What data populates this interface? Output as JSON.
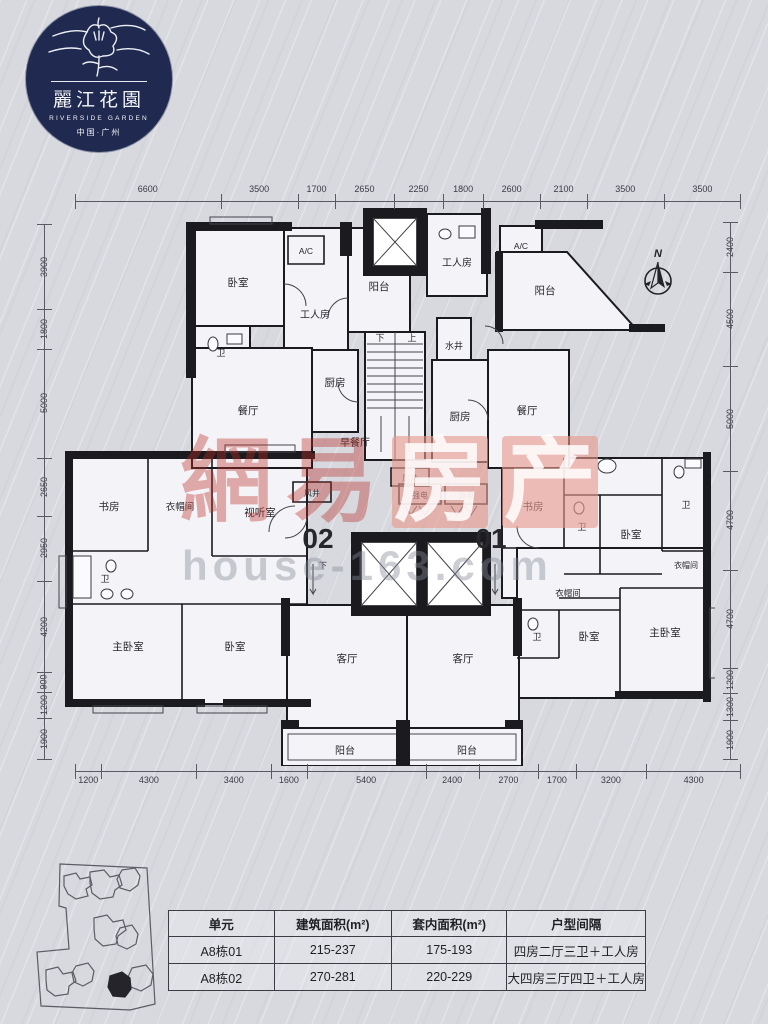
{
  "logo": {
    "name_cn": "麗江花園",
    "name_en": "RIVERSIDE GARDEN",
    "location": "中国·广州",
    "navy": "#202a50"
  },
  "compass": {
    "label": "N"
  },
  "dimensions": {
    "top": [
      6600,
      3500,
      1700,
      2650,
      2250,
      1800,
      2600,
      2100,
      3500,
      3500
    ],
    "bottom": [
      1200,
      4300,
      3400,
      1600,
      5400,
      2400,
      2700,
      1700,
      3200,
      4300
    ],
    "left": [
      3900,
      1800,
      5000,
      2650,
      2950,
      4200,
      900,
      1200,
      1900
    ],
    "right": [
      2400,
      4500,
      5000,
      4700,
      4700,
      1200,
      1300,
      1900
    ]
  },
  "plan": {
    "unit_left": "02",
    "unit_right": "01",
    "labels": {
      "bedroom": "卧室",
      "master_bedroom": "主卧室",
      "living_room": "客厅",
      "dining_room": "餐厅",
      "kitchen": "厨房",
      "balcony": "阳台",
      "worker_room": "工人房",
      "bathroom": "卫",
      "study": "书房",
      "cloakroom": "衣帽间",
      "av_room": "视听室",
      "breakfast_room": "早餐厅",
      "water_shaft": "水井",
      "air_shaft": "风井",
      "strong_electric": "强电",
      "weak_electric": "弱电",
      "up": "上",
      "down": "下",
      "ac": "A/C"
    },
    "accent_red": "#c4261d",
    "wall_color": "#1b1b1f"
  },
  "watermark": {
    "char1": "網",
    "char2": "易",
    "char3": "房",
    "char4": "产",
    "url": "house-163.com",
    "red": "#ba2c26",
    "pink": "#e9988c"
  },
  "table": {
    "headers": [
      "单元",
      "建筑面积(m²)",
      "套内面积(m²)",
      "户型间隔"
    ],
    "rows": [
      [
        "A8栋01",
        "215-237",
        "175-193",
        "四房二厅三卫＋工人房"
      ],
      [
        "A8栋02",
        "270-281",
        "220-229",
        "大四房三厅四卫＋工人房"
      ]
    ]
  }
}
